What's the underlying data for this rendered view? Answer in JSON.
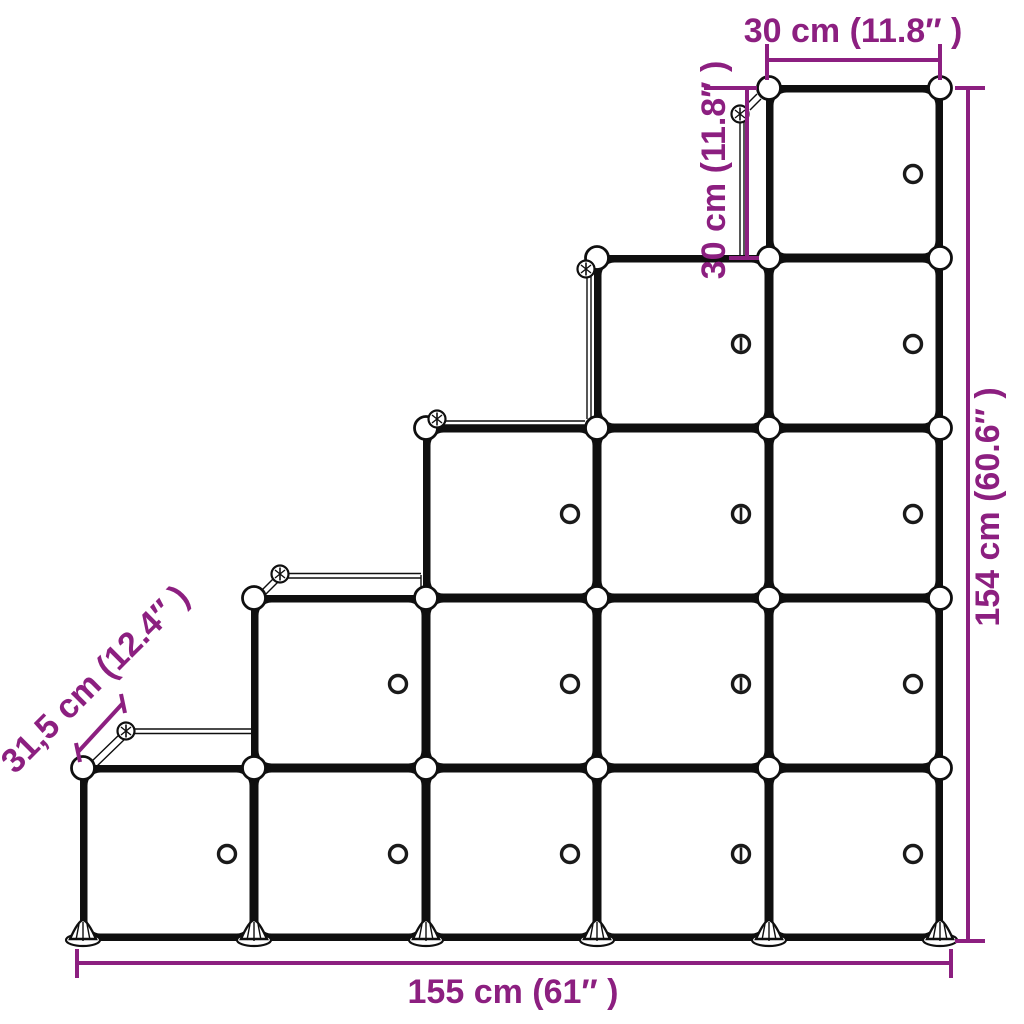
{
  "diagram": {
    "name": "Cube storage staircase dimension diagram",
    "labels": {
      "top_width": "30 cm (11.8″ )",
      "cube_height": "30 cm (11.8″ )",
      "total_height": "154 cm (60.6″ )",
      "total_width": "155 cm (61″ )",
      "depth": "31,5 cm (12.4″ )"
    },
    "structure": {
      "columns": 5,
      "cubes_per_column": [
        1,
        2,
        3,
        4,
        5
      ],
      "total_cubes": 15,
      "corner_ball_connectors": true,
      "door_knob_per_cube": true,
      "slotted_knob_column": 4,
      "feet_count": 6
    },
    "colors": {
      "annotation": "#8C1F80",
      "outline": "#0f0f0f",
      "background": "#ffffff"
    }
  }
}
